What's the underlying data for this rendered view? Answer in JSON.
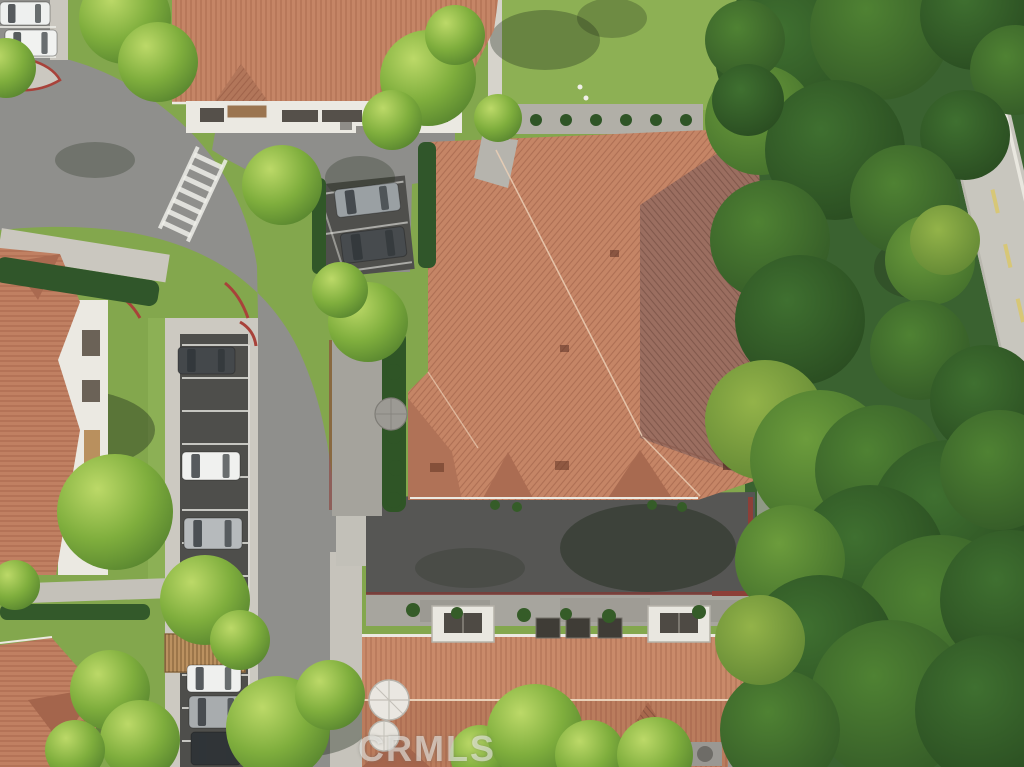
{
  "watermark": {
    "text": "CRMLS"
  },
  "palette": {
    "roof": "#c58566",
    "roof_shadow": "#9b6e60",
    "asphalt": "#8f8f8c",
    "asphalt_dark": "#4e4e4b",
    "concrete": "#cac7bf",
    "grass": "#83a74d",
    "forest": "#3a6230",
    "white_wall": "#ebe9e2",
    "red_curb": "#a8423a",
    "hedge": "#2f5526",
    "shrub": "#355c28",
    "stall_line": "#eeeee9",
    "road_dash_yellow": "#d9c76b",
    "tree_shadow": "#1f2a1a",
    "car_white": "#f0f1ef",
    "car_silver": "#aeb2b4",
    "car_dark": "#3a3e41"
  },
  "scene": {
    "cars": [
      {
        "x": 0,
        "y": 2,
        "w": 50,
        "h": 23,
        "a": 0,
        "c": "#eef0ef",
        "name": "white-car"
      },
      {
        "x": 5,
        "y": 30,
        "w": 52,
        "h": 26,
        "a": 0,
        "c": "#f1f2f0",
        "name": "white-car"
      },
      {
        "x": 178,
        "y": 347,
        "w": 57,
        "h": 27,
        "a": 0,
        "c": "#44484b",
        "name": "dark-car"
      },
      {
        "x": 182,
        "y": 452,
        "w": 58,
        "h": 28,
        "a": 0,
        "c": "#f0f1ef",
        "name": "white-car"
      },
      {
        "x": 184,
        "y": 518,
        "w": 58,
        "h": 31,
        "a": 0,
        "c": "#b6babc",
        "name": "silver-suv"
      },
      {
        "x": 187,
        "y": 665,
        "w": 54,
        "h": 27,
        "a": 0,
        "c": "#eff0ee",
        "name": "white-car"
      },
      {
        "x": 189,
        "y": 696,
        "w": 55,
        "h": 32,
        "a": 0,
        "c": "#a8acae",
        "name": "silver-car"
      },
      {
        "x": 191,
        "y": 732,
        "w": 50,
        "h": 33,
        "a": 0,
        "c": "#303437",
        "name": "dark-car"
      },
      {
        "x": 334,
        "y": 190,
        "w": 64,
        "h": 28,
        "a": -7,
        "c": "#9aa0a3",
        "name": "silver-pickup"
      },
      {
        "x": 340,
        "y": 234,
        "w": 64,
        "h": 30,
        "a": -7,
        "c": "#474b4e",
        "name": "dark-suv"
      }
    ],
    "stall_lines": {
      "x1": 182,
      "x2": 248,
      "ys": [
        345,
        378,
        411,
        444,
        477,
        510,
        543,
        576,
        609,
        642,
        675,
        708,
        741
      ]
    },
    "pocket_lines": [
      {
        "x1": 0,
        "y1": 27,
        "x2": 56,
        "y2": 27
      },
      {
        "x1": 0,
        "y1": 57,
        "x2": 56,
        "y2": 57
      }
    ],
    "shadows": [
      {
        "x": 60,
        "y": 430,
        "rx": 95,
        "ry": 42,
        "o": 0.4
      },
      {
        "x": 95,
        "y": 160,
        "rx": 40,
        "ry": 18,
        "o": 0.28
      },
      {
        "x": 240,
        "y": 100,
        "rx": 35,
        "ry": 20,
        "o": 0.25
      },
      {
        "x": 360,
        "y": 178,
        "rx": 35,
        "ry": 22,
        "o": 0.28
      },
      {
        "x": 300,
        "y": 722,
        "rx": 70,
        "ry": 35,
        "o": 0.38
      },
      {
        "x": 60,
        "y": 720,
        "rx": 60,
        "ry": 35,
        "o": 0.33
      },
      {
        "x": 648,
        "y": 548,
        "rx": 88,
        "ry": 44,
        "o": 0.45
      },
      {
        "x": 470,
        "y": 568,
        "rx": 55,
        "ry": 20,
        "o": 0.22
      },
      {
        "x": 912,
        "y": 268,
        "rx": 38,
        "ry": 30,
        "o": 0.28
      },
      {
        "x": 545,
        "y": 40,
        "rx": 55,
        "ry": 30,
        "o": 0.33
      },
      {
        "x": 612,
        "y": 18,
        "rx": 35,
        "ry": 20,
        "o": 0.28
      }
    ],
    "trees": [
      {
        "x": 125,
        "y": 18,
        "r": 46
      },
      {
        "x": 158,
        "y": 62,
        "r": 40
      },
      {
        "x": 6,
        "y": 68,
        "r": 30
      },
      {
        "x": 282,
        "y": 185,
        "r": 40
      },
      {
        "x": 428,
        "y": 78,
        "r": 48
      },
      {
        "x": 392,
        "y": 120,
        "r": 30
      },
      {
        "x": 455,
        "y": 35,
        "r": 30
      },
      {
        "x": 498,
        "y": 118,
        "r": 24
      },
      {
        "x": 115,
        "y": 512,
        "r": 58
      },
      {
        "x": 15,
        "y": 585,
        "r": 25
      },
      {
        "x": 205,
        "y": 600,
        "r": 45
      },
      {
        "x": 240,
        "y": 640,
        "r": 30
      },
      {
        "x": 368,
        "y": 322,
        "r": 40
      },
      {
        "x": 340,
        "y": 290,
        "r": 28
      },
      {
        "x": 278,
        "y": 728,
        "r": 52
      },
      {
        "x": 330,
        "y": 695,
        "r": 35
      },
      {
        "x": 480,
        "y": 755,
        "r": 30
      },
      {
        "x": 535,
        "y": 732,
        "r": 48
      },
      {
        "x": 590,
        "y": 755,
        "r": 35
      },
      {
        "x": 655,
        "y": 755,
        "r": 38
      },
      {
        "x": 110,
        "y": 690,
        "r": 40
      },
      {
        "x": 140,
        "y": 740,
        "r": 40
      },
      {
        "x": 75,
        "y": 750,
        "r": 30
      }
    ],
    "forest": [
      {
        "x": 795,
        "y": 55,
        "r": 80,
        "t": "d"
      },
      {
        "x": 880,
        "y": 30,
        "r": 70,
        "t": "m"
      },
      {
        "x": 975,
        "y": 15,
        "r": 55,
        "t": "d"
      },
      {
        "x": 1015,
        "y": 70,
        "r": 45,
        "t": "m"
      },
      {
        "x": 760,
        "y": 120,
        "r": 55,
        "t": "l"
      },
      {
        "x": 835,
        "y": 150,
        "r": 70,
        "t": "d"
      },
      {
        "x": 965,
        "y": 135,
        "r": 45,
        "t": "d"
      },
      {
        "x": 745,
        "y": 40,
        "r": 40,
        "t": "m"
      },
      {
        "x": 748,
        "y": 100,
        "r": 36,
        "t": "d"
      },
      {
        "x": 905,
        "y": 200,
        "r": 55,
        "t": "m"
      },
      {
        "x": 770,
        "y": 240,
        "r": 60,
        "t": "m"
      },
      {
        "x": 800,
        "y": 320,
        "r": 65,
        "t": "d"
      },
      {
        "x": 930,
        "y": 260,
        "r": 45,
        "t": "l"
      },
      {
        "x": 920,
        "y": 350,
        "r": 50,
        "t": "m"
      },
      {
        "x": 985,
        "y": 400,
        "r": 55,
        "t": "d"
      },
      {
        "x": 945,
        "y": 240,
        "r": 35,
        "t": "y"
      },
      {
        "x": 765,
        "y": 420,
        "r": 60,
        "t": "y"
      },
      {
        "x": 820,
        "y": 460,
        "r": 70,
        "t": "l"
      },
      {
        "x": 880,
        "y": 470,
        "r": 65,
        "t": "m"
      },
      {
        "x": 950,
        "y": 520,
        "r": 80,
        "t": "d"
      },
      {
        "x": 1000,
        "y": 470,
        "r": 60,
        "t": "m"
      },
      {
        "x": 870,
        "y": 560,
        "r": 75,
        "t": "d"
      },
      {
        "x": 790,
        "y": 560,
        "r": 55,
        "t": "l"
      },
      {
        "x": 940,
        "y": 620,
        "r": 85,
        "t": "m"
      },
      {
        "x": 1010,
        "y": 600,
        "r": 70,
        "t": "d"
      },
      {
        "x": 820,
        "y": 650,
        "r": 75,
        "t": "d"
      },
      {
        "x": 890,
        "y": 700,
        "r": 80,
        "t": "m"
      },
      {
        "x": 990,
        "y": 710,
        "r": 75,
        "t": "d"
      },
      {
        "x": 780,
        "y": 730,
        "r": 60,
        "t": "m"
      },
      {
        "x": 760,
        "y": 640,
        "r": 45,
        "t": "y"
      }
    ],
    "lawn_bumps": {
      "y": 120,
      "r": 6,
      "xs": [
        506,
        536,
        566,
        596,
        626,
        656,
        686
      ]
    },
    "west_bumps": [
      [
        392,
        340
      ],
      [
        394,
        372
      ],
      [
        396,
        404
      ],
      [
        394,
        436
      ],
      [
        396,
        468
      ],
      [
        394,
        500
      ]
    ],
    "wall_shrubs": [
      [
        413,
        610,
        7
      ],
      [
        457,
        613,
        6
      ],
      [
        524,
        615,
        7
      ],
      [
        566,
        614,
        6
      ],
      [
        609,
        616,
        7
      ],
      [
        699,
        612,
        7
      ],
      [
        741,
        615,
        6
      ]
    ],
    "south_shrubs": [
      [
        495,
        505
      ],
      [
        517,
        507
      ],
      [
        652,
        505
      ],
      [
        682,
        507
      ]
    ]
  }
}
